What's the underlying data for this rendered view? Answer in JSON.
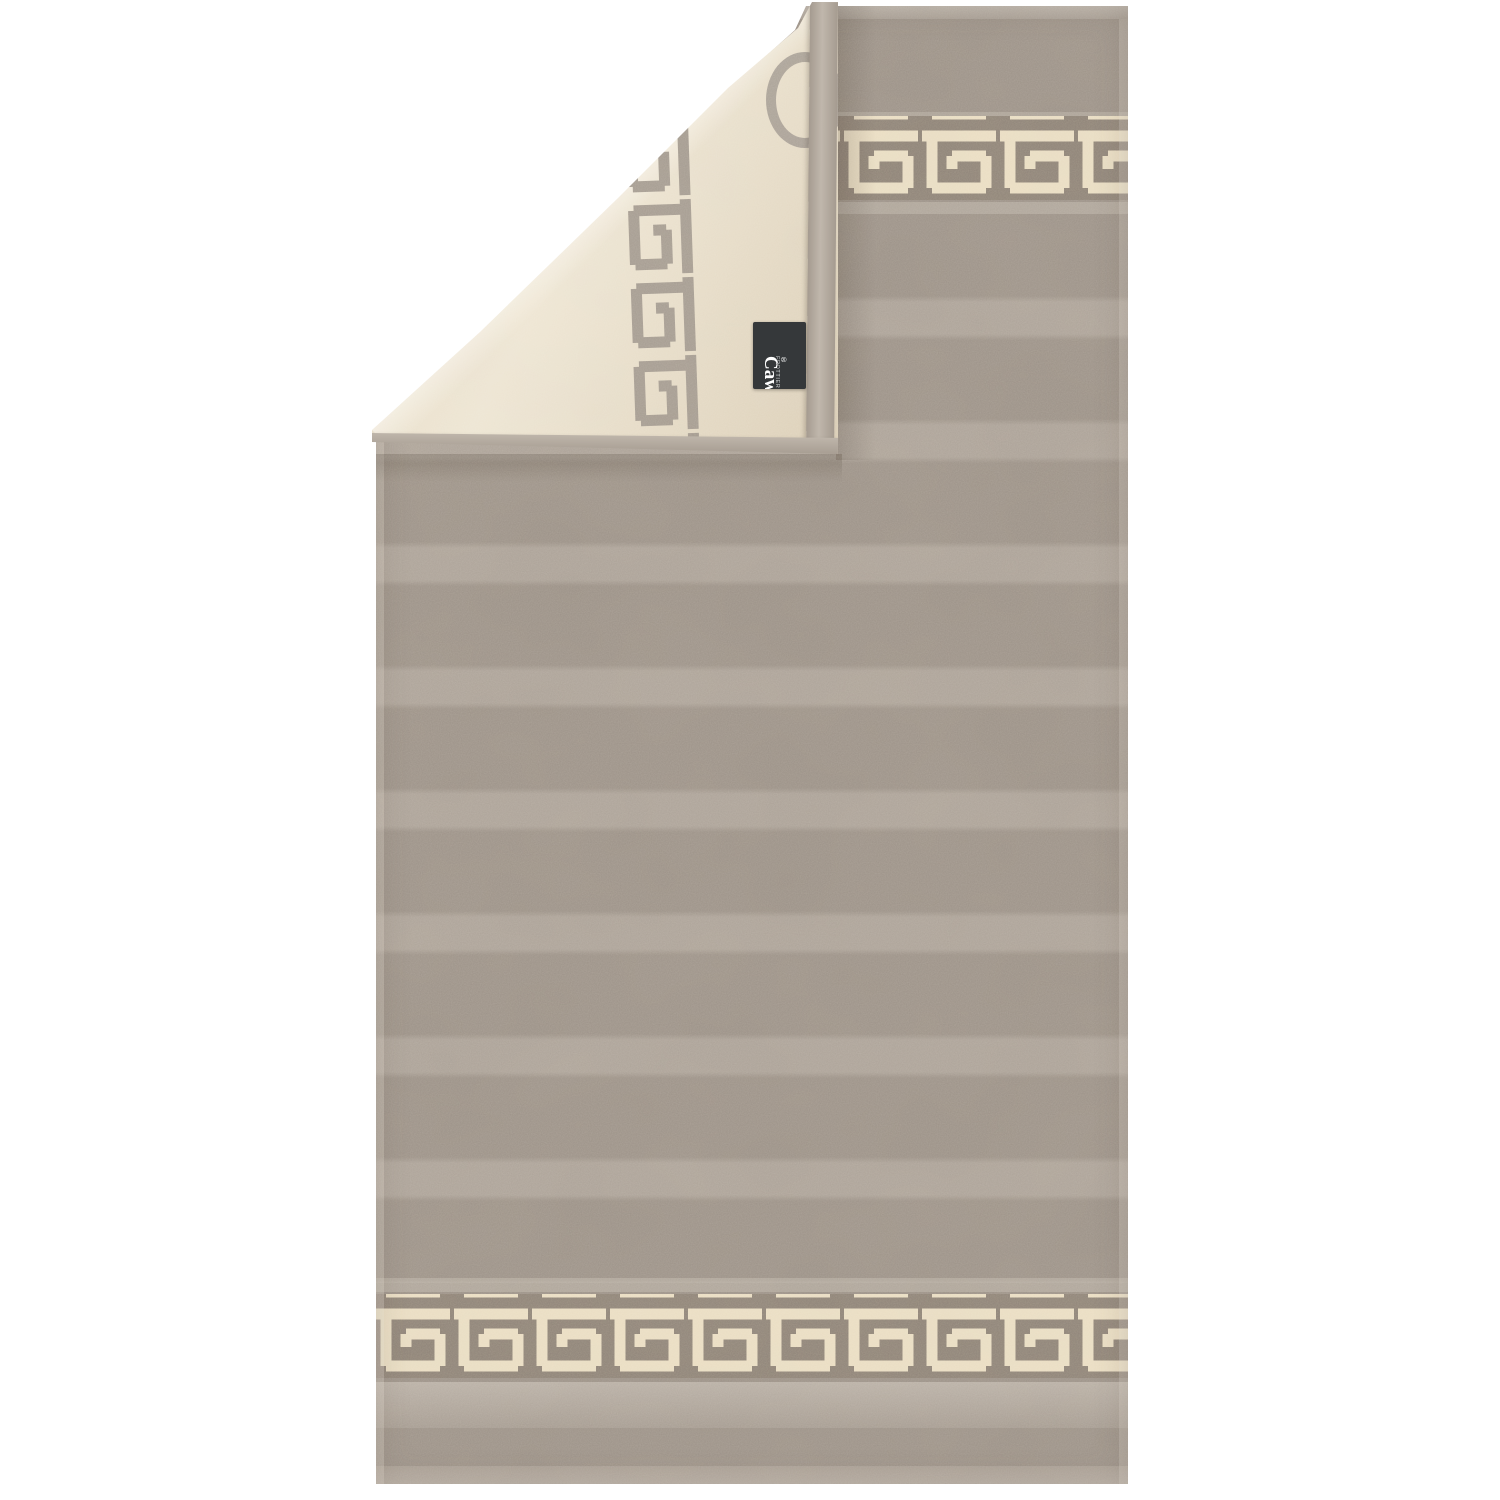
{
  "product_photo": {
    "subject": "two-tone terry towel with greek key border, top-left corner folded over showing reverse side",
    "pattern_name": "greek-key-meander",
    "brand_label": {
      "brand_small": "FROTTIER",
      "brand": "Cawö",
      "registered_mark": "®"
    },
    "colors": {
      "background": "#ffffff",
      "towel_front": "#9a9086",
      "towel_front_stripe": "#aaa096",
      "border_band": "#8c8176",
      "border_pattern_cream": "#e9dcc1",
      "towel_back": "#e7dbc3",
      "back_pattern_grey": "#a39a8f",
      "edge_tape": "#b3aa9f",
      "label_background": "#35383a",
      "label_text": "#ffffff"
    }
  }
}
